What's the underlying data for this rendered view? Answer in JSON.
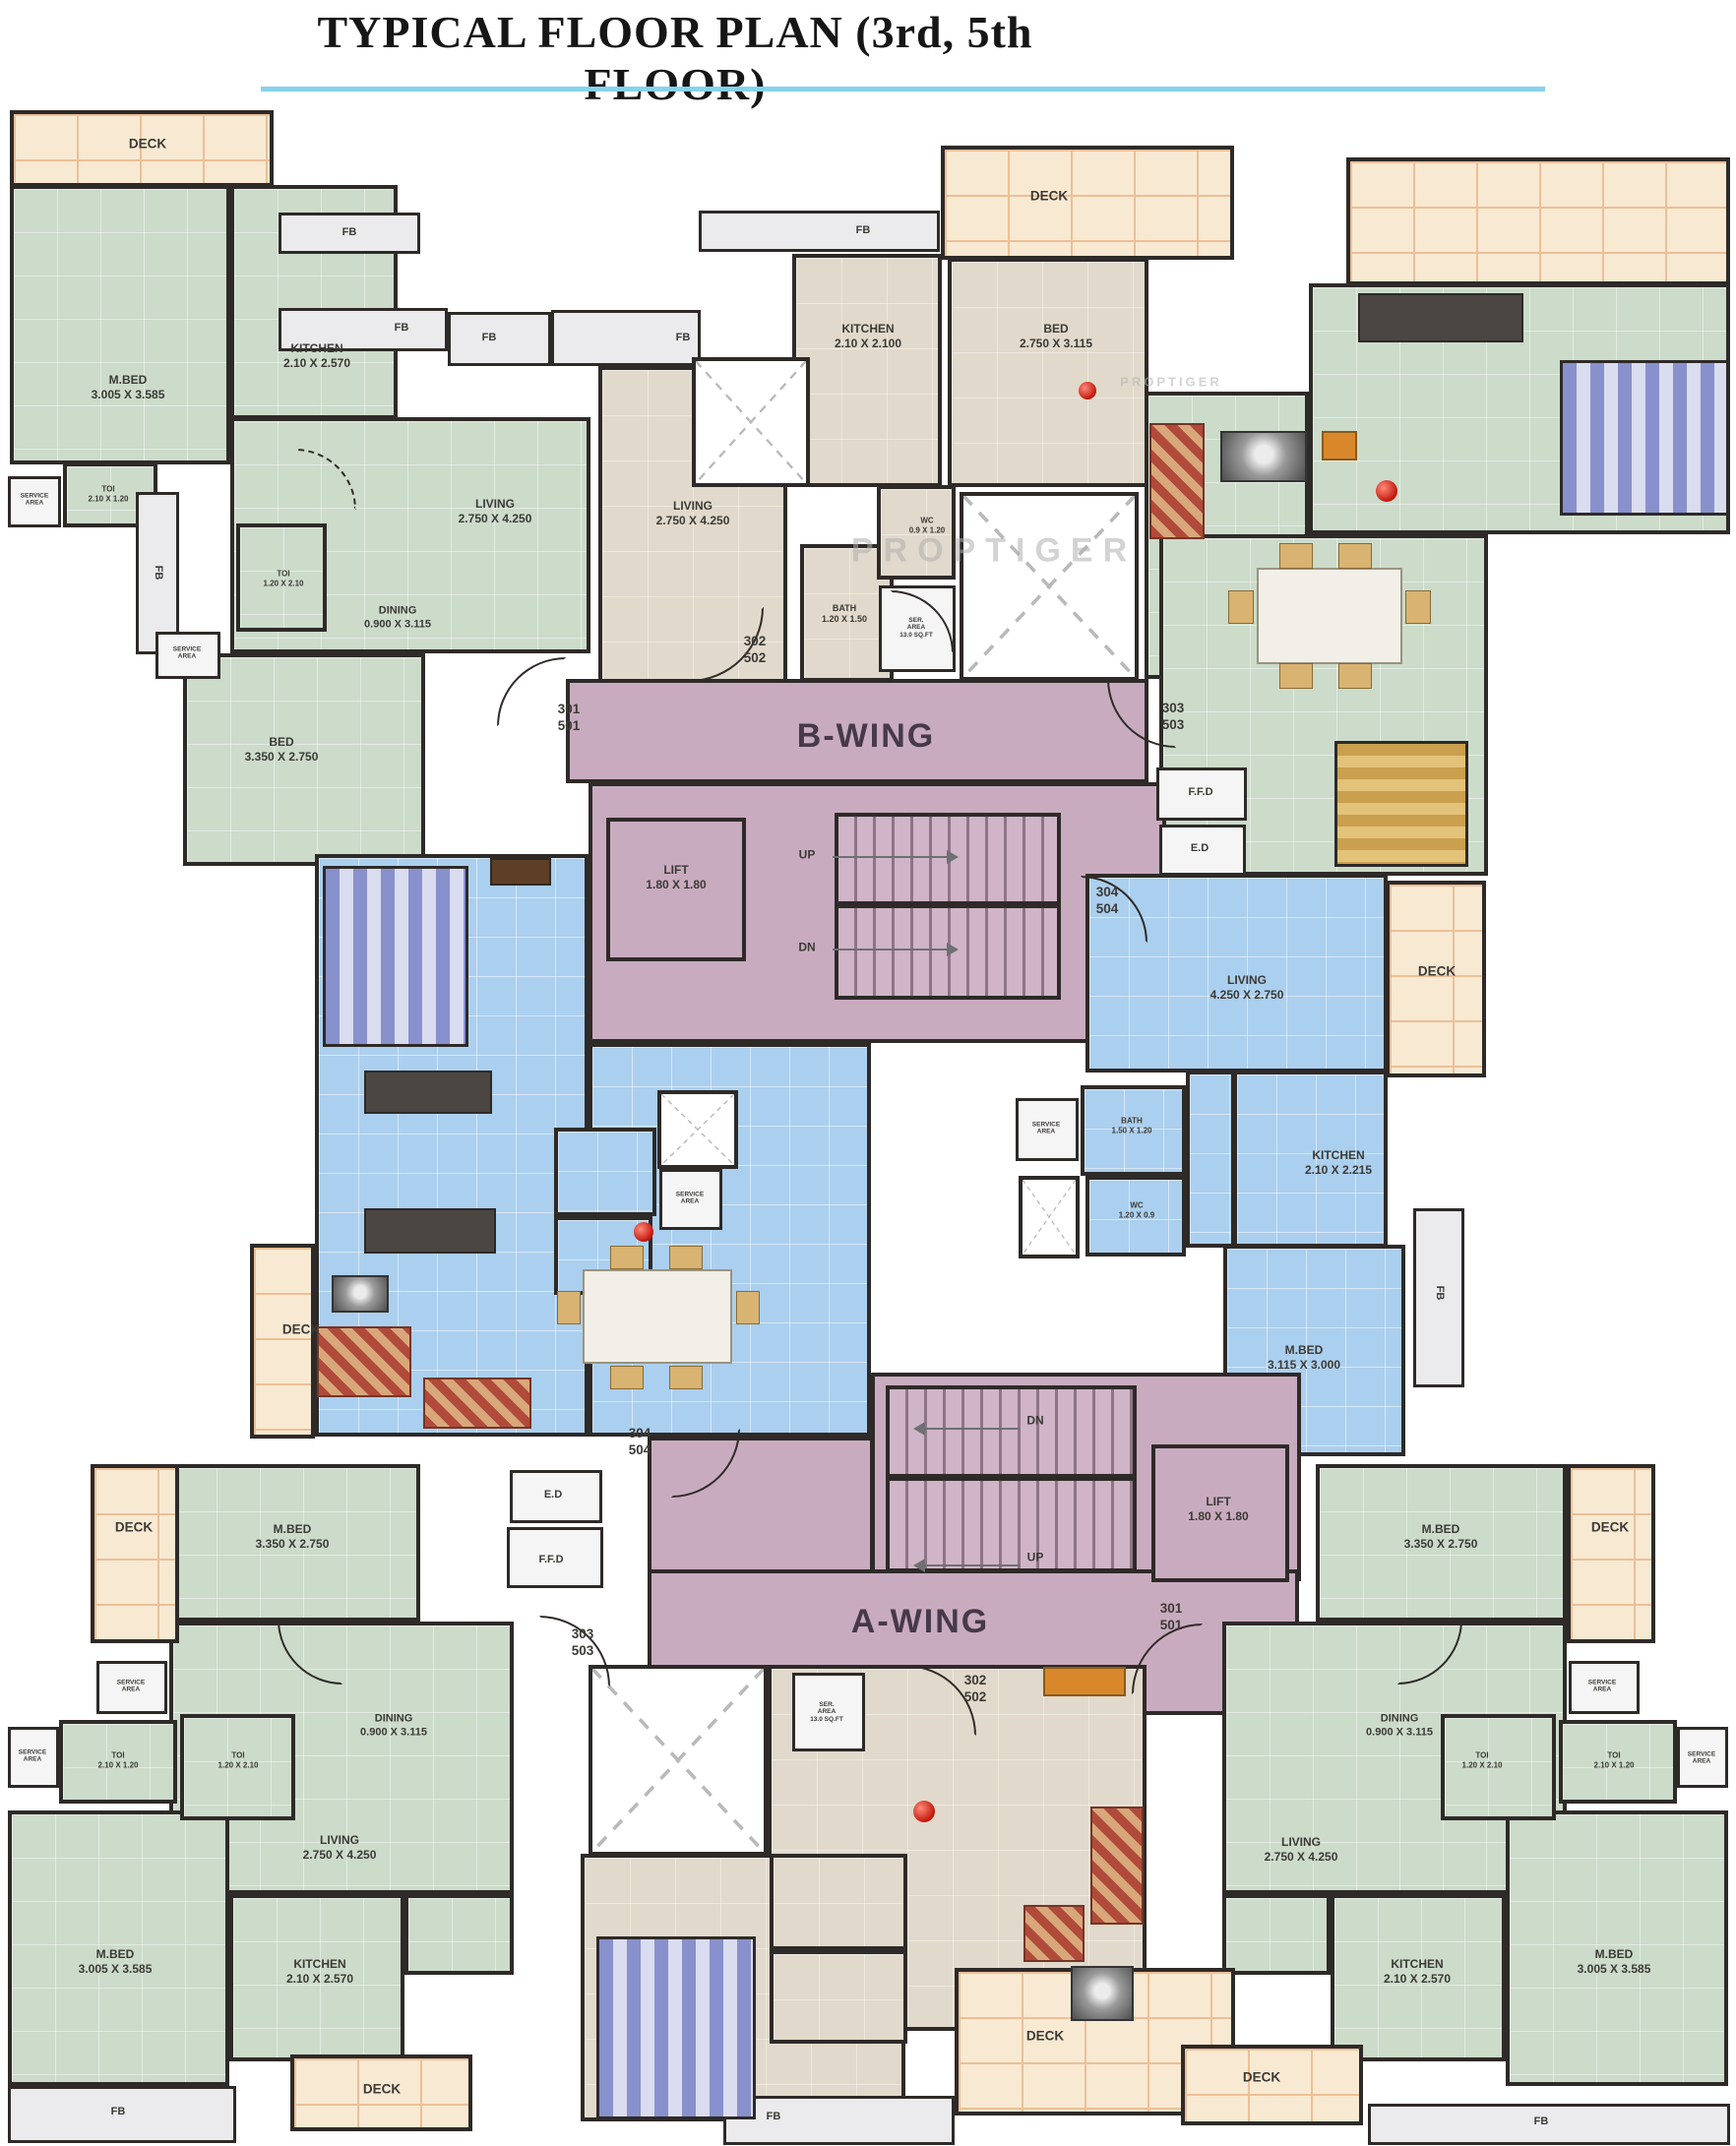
{
  "title": "TYPICAL FLOOR PLAN (3rd, 5th FLOOR)",
  "watermark": "PROPTIGER",
  "colors": {
    "accent_rule": "#86d2ec",
    "wall": "#2e2a28",
    "green_room": "#ccdbca",
    "tan_room": "#e1d9cb",
    "blue_room": "#abcfee",
    "corridor_pink": "#c9abbf",
    "deck_peach": "#f8e9d2"
  },
  "wings": {
    "b": "B-WING",
    "a": "A-WING"
  },
  "corridor": {
    "lift": "LIFT\n1.80 X 1.80",
    "up": "UP",
    "dn": "DN",
    "ffd": "F.F.D",
    "ed": "E.D"
  },
  "doors": {
    "d301": "301\n501",
    "d302": "302\n502",
    "d303": "303\n503",
    "d304": "304\n504"
  },
  "common": {
    "fb": "FB",
    "deck": "DECK",
    "service_area": "SERVICE\nAREA",
    "ser_area_sqft": "SER.\nAREA\n13.0 SQ.FT"
  },
  "units": {
    "tl": {
      "mbed": "M.BED\n3.005 X 3.585",
      "kitchen": "KITCHEN\n2.10 X 2.570",
      "living": "LIVING\n2.750 X 4.250",
      "dining": "DINING\n0.900 X 3.115",
      "bed": "BED\n3.350 X 2.750",
      "toi_a": "TOI\n2.10 X 1.20",
      "toi_b": "TOI\n1.20 X 2.10"
    },
    "tm": {
      "kitchen": "KITCHEN\n2.10 X 2.100",
      "bed": "BED\n2.750 X 3.115",
      "living": "LIVING\n2.750 X 4.250",
      "bath": "BATH\n1.20 X 1.50",
      "wc": "WC\n0.9 X 1.20"
    },
    "rb": {
      "living": "LIVING\n4.250 X 2.750",
      "kitchen": "KITCHEN\n2.10 X 2.215",
      "mbed": "M.BED\n3.115 X 3.000",
      "bath": "BATH\n1.50 X 1.20",
      "wc": "WC\n1.20 X 0.9"
    },
    "bl": {
      "mbed": "M.BED\n3.350 X 2.750",
      "dining": "DINING\n0.900 X 3.115",
      "living": "LIVING\n2.750 X 4.250",
      "mbed2": "M.BED\n3.005 X 3.585",
      "kitchen": "KITCHEN\n2.10 X 2.570",
      "toi_a": "TOI\n2.10 X 1.20",
      "toi_b": "TOI\n1.20 X 2.10"
    },
    "br": {
      "mbed": "M.BED\n3.350 X 2.750",
      "dining": "DINING\n0.900 X 3.115",
      "living": "LIVING\n2.750 X 4.250",
      "mbed2": "M.BED\n3.005 X 3.585",
      "kitchen": "KITCHEN\n2.10 X 2.570",
      "toi_a": "TOI\n2.10 X 1.20",
      "toi_b": "TOI\n1.20 X 2.10"
    }
  }
}
